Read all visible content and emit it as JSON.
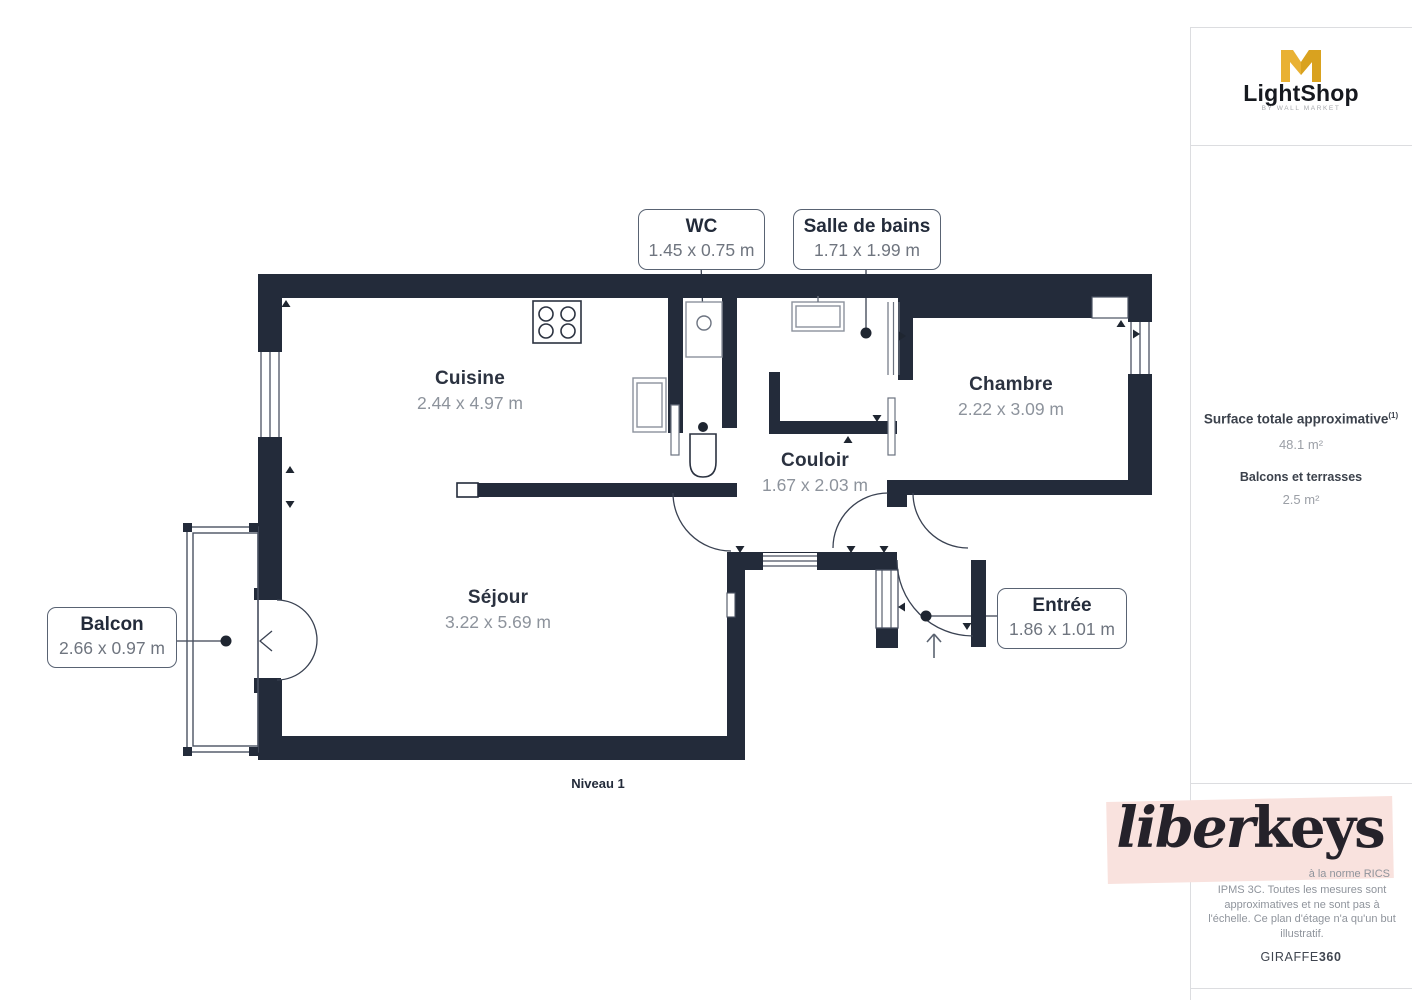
{
  "plan": {
    "level_label": "Niveau 1",
    "wall_color": "#232b3a",
    "rooms": [
      {
        "name": "Cuisine",
        "dims": "2.44 x 4.97 m"
      },
      {
        "name": "Séjour",
        "dims": "3.22 x 5.69 m"
      },
      {
        "name": "Chambre",
        "dims": "2.22 x 3.09 m"
      },
      {
        "name": "Couloir",
        "dims": "1.67 x 2.03 m"
      }
    ],
    "callouts": [
      {
        "name": "WC",
        "dims": "1.45 x 0.75 m"
      },
      {
        "name": "Salle de bains",
        "dims": "1.71 x 1.99 m"
      },
      {
        "name": "Balcon",
        "dims": "2.66 x 0.97 m"
      },
      {
        "name": "Entrée",
        "dims": "1.86 x 1.01 m"
      }
    ]
  },
  "sidebar": {
    "brand": {
      "name": "LightShop",
      "tagline": "BY WALL MARKET",
      "logo_color": "#e9b133"
    },
    "surface": {
      "label": "Surface totale approximative",
      "sup": "(1)",
      "value": "48.1 m²",
      "balconies_label": "Balcons et terrasses",
      "balconies_value": "2.5 m²"
    },
    "disclaimer": {
      "fragment": "à la norme RICS",
      "lines": [
        "IPMS 3C. Toutes les mesures sont",
        "approximatives et ne sont pas à",
        "l'échelle. Ce plan d'étage n'a qu'un but",
        "illustratif."
      ]
    },
    "credit": {
      "brand": "GIRAFFE",
      "suffix": "360"
    },
    "watermark": {
      "script": "liber",
      "serif": "keys",
      "band_color": "#f9e2de"
    }
  }
}
